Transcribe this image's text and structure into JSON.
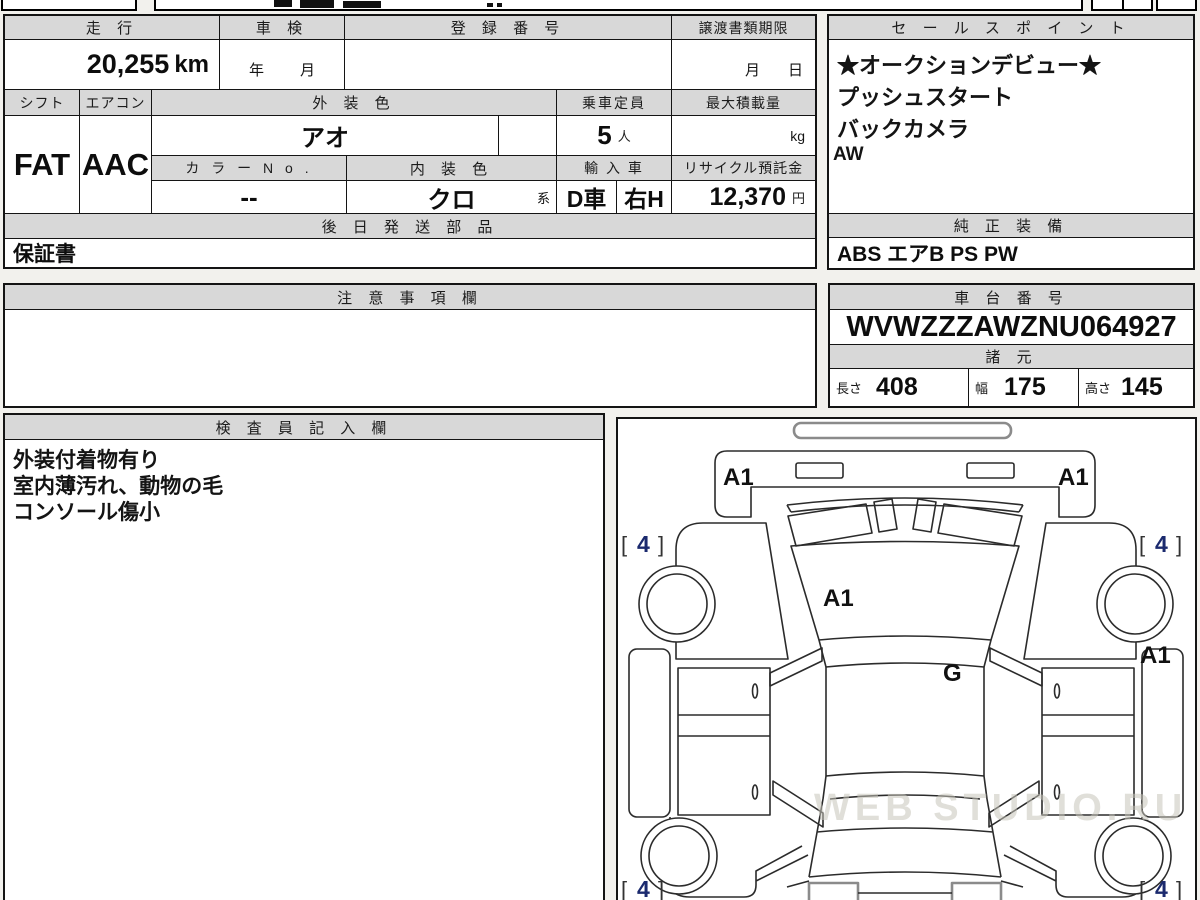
{
  "main_table": {
    "mileage": {
      "label": "走 行",
      "value": "20,255",
      "unit": "km"
    },
    "shaken": {
      "label": "車 検",
      "year": "年",
      "month": "月"
    },
    "registration": {
      "label": "登 録 番 号",
      "value": ""
    },
    "transfer": {
      "label": "譲渡書類期限",
      "month": "月",
      "day": "日"
    },
    "shift": {
      "label": "シフト",
      "value": "FAT"
    },
    "aircon": {
      "label": "エアコン",
      "value": "AAC"
    },
    "exterior_color": {
      "label": "外 装 色",
      "value": "アオ"
    },
    "capacity": {
      "label": "乗車定員",
      "value": "5",
      "unit": "人"
    },
    "max_load": {
      "label": "最大積載量",
      "value": "",
      "unit": "kg"
    },
    "color_no": {
      "label": "カ ラ ー N o .",
      "value": "--"
    },
    "interior_color": {
      "label": "内 装 色",
      "value": "クロ",
      "suffix": "系"
    },
    "import": {
      "label": "輸 入 車",
      "domestic": "D車",
      "handle": "右H"
    },
    "recycle": {
      "label": "リサイクル預託金",
      "value": "12,370",
      "unit": "円"
    },
    "later_parts": {
      "label": "後 日 発 送 部 品",
      "value": "保証書"
    }
  },
  "sales": {
    "label": "セ ー ル ス ポ イ ン ト",
    "items": [
      "★オークションデビュー★",
      "プッシュスタート",
      "バックカメラ",
      "AW"
    ]
  },
  "equipment": {
    "label": "純 正 装 備",
    "value": "ABS エアB PS PW"
  },
  "notes": {
    "label": "注 意 事 項 欄",
    "value": ""
  },
  "chassis": {
    "label": "車 台 番 号",
    "value": "WVWZZZAWZNU064927"
  },
  "specs": {
    "label": "諸 元",
    "items": [
      {
        "label": "長さ",
        "value": "408"
      },
      {
        "label": "幅",
        "value": "175"
      },
      {
        "label": "高さ",
        "value": "145"
      }
    ]
  },
  "inspector": {
    "label": "検 査 員 記 入 欄",
    "lines": [
      "外装付着物有り",
      "室内薄汚れ、動物の毛",
      "コンソール傷小"
    ]
  },
  "diagram": {
    "panel_mark": "A1",
    "glass_mark": "G",
    "tire_mark": "4",
    "bracket_open": "[",
    "bracket_close": "]",
    "watermark": "WEB STUDIO.RU"
  }
}
